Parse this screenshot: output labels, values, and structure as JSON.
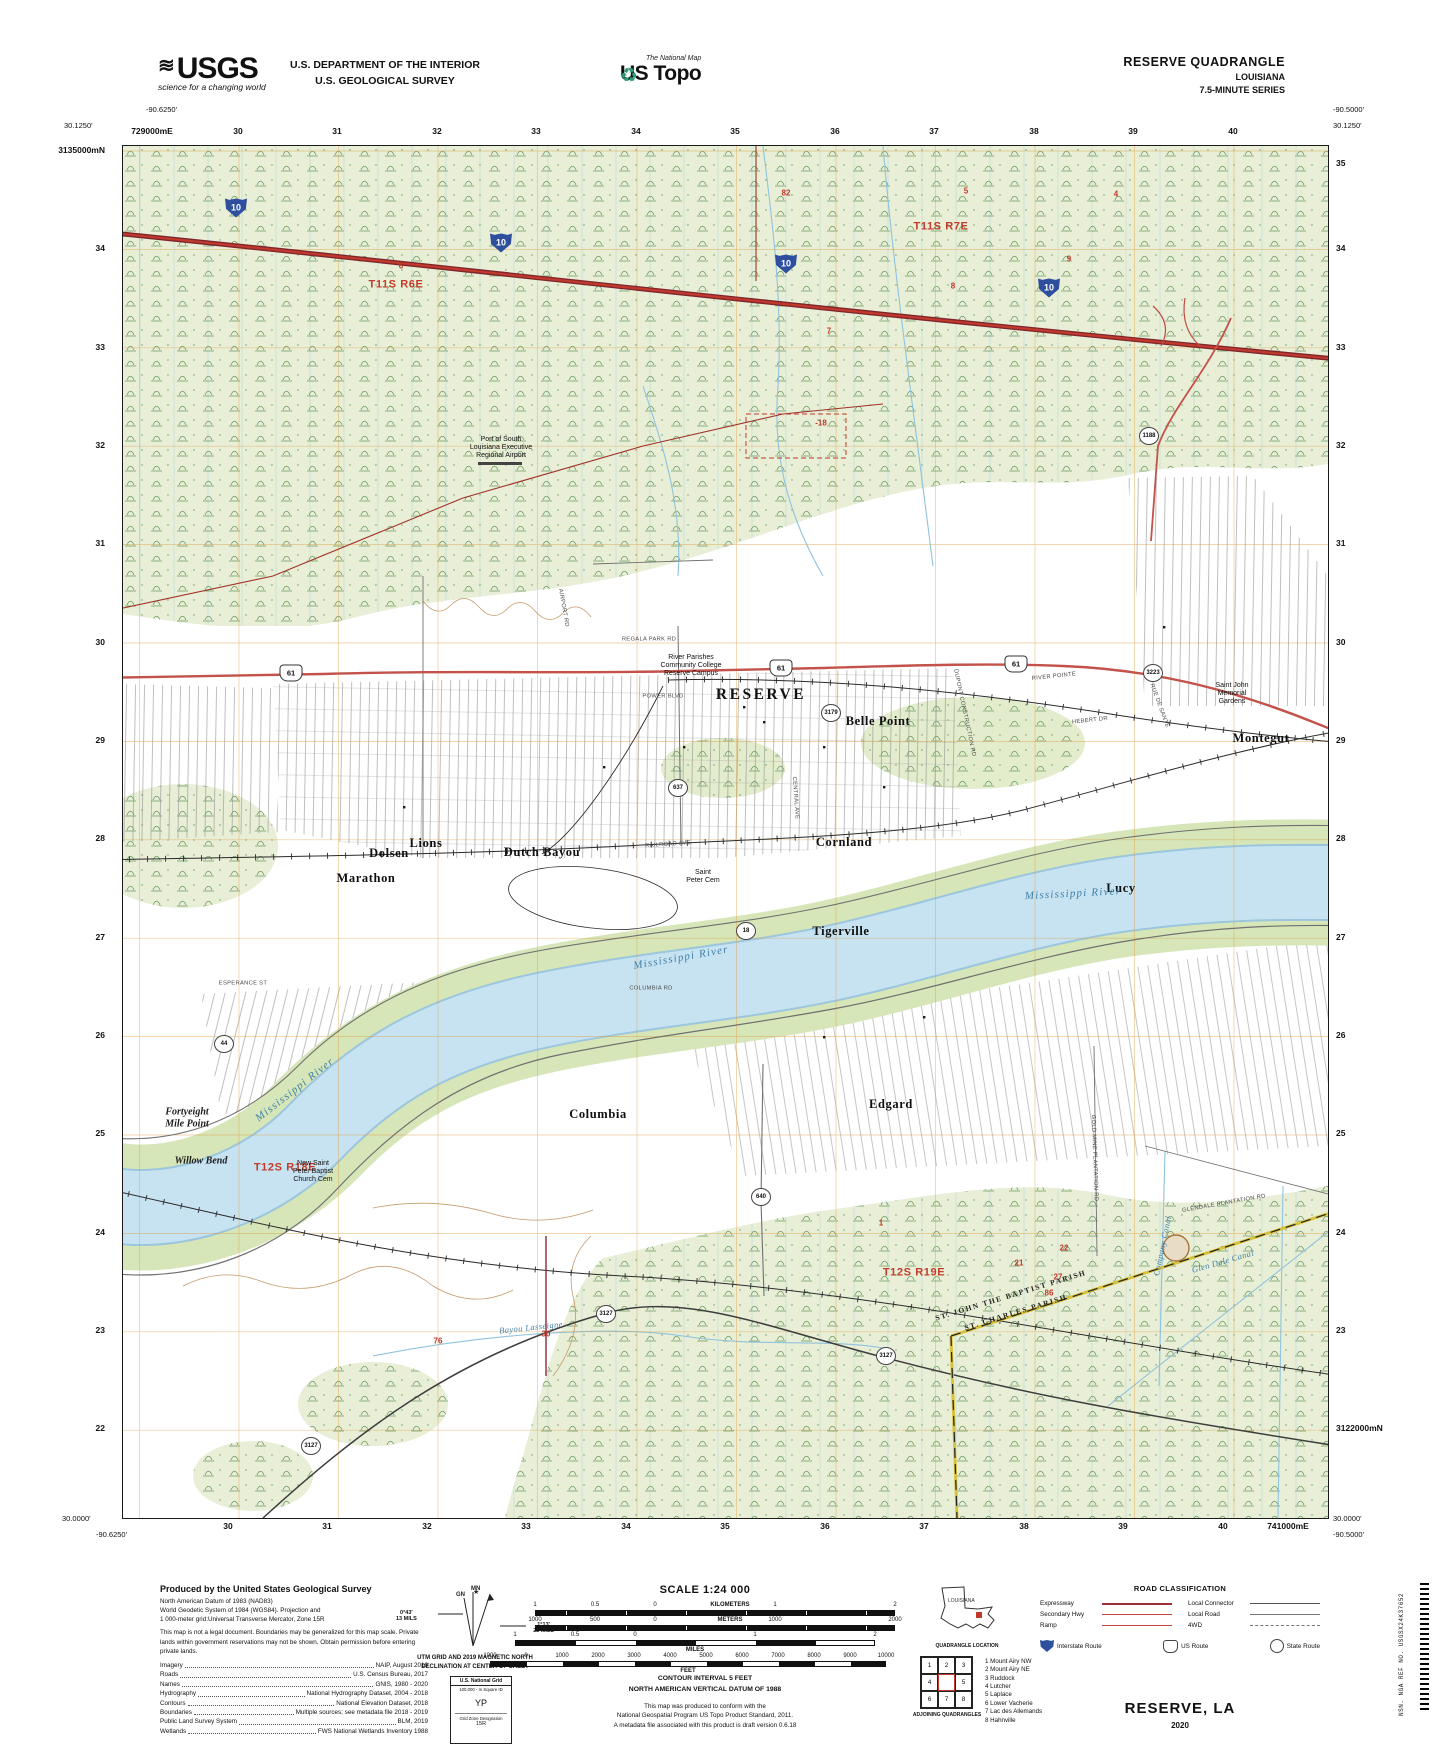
{
  "header": {
    "usgs_word": "USGS",
    "usgs_tagline": "science for a changing world",
    "dept_line1": "U.S. DEPARTMENT OF THE INTERIOR",
    "dept_line2": "U.S. GEOLOGICAL SURVEY",
    "natmap_small": "The National Map",
    "natmap_big": "US Topo",
    "quad_title": "RESERVE QUADRANGLE",
    "quad_state": "LOUISIANA",
    "quad_series": "7.5-MINUTE SERIES"
  },
  "map": {
    "corners": {
      "tl_lon": "-90.6250'",
      "tl_lat": "30.1250'",
      "tr_lon": "-90.5000'",
      "tr_lat": "30.1250'",
      "bl_lat": "30.0000'",
      "bl_lon": "-90.6250'",
      "br_lat": "30.0000'",
      "br_lon": "-90.5000'"
    },
    "utm_top": [
      {
        "t": "729000mE",
        "x": 152
      },
      {
        "t": "30",
        "x": 238
      },
      {
        "t": "31",
        "x": 337
      },
      {
        "t": "32",
        "x": 437
      },
      {
        "t": "33",
        "x": 536
      },
      {
        "t": "34",
        "x": 636
      },
      {
        "t": "35",
        "x": 735
      },
      {
        "t": "36",
        "x": 835
      },
      {
        "t": "37",
        "x": 934
      },
      {
        "t": "38",
        "x": 1034
      },
      {
        "t": "39",
        "x": 1133
      },
      {
        "t": "40",
        "x": 1233
      }
    ],
    "utm_bottom": [
      {
        "t": "30",
        "x": 228
      },
      {
        "t": "31",
        "x": 327
      },
      {
        "t": "32",
        "x": 427
      },
      {
        "t": "33",
        "x": 526
      },
      {
        "t": "34",
        "x": 626
      },
      {
        "t": "35",
        "x": 725
      },
      {
        "t": "36",
        "x": 825
      },
      {
        "t": "37",
        "x": 924
      },
      {
        "t": "38",
        "x": 1024
      },
      {
        "t": "39",
        "x": 1123
      },
      {
        "t": "40",
        "x": 1223
      },
      {
        "t": "741000mE",
        "x": 1288
      }
    ],
    "utm_left": [
      {
        "t": "3135000mN",
        "y": 150
      },
      {
        "t": "34",
        "y": 248
      },
      {
        "t": "33",
        "y": 347
      },
      {
        "t": "32",
        "y": 445
      },
      {
        "t": "31",
        "y": 543
      },
      {
        "t": "30",
        "y": 642
      },
      {
        "t": "29",
        "y": 740
      },
      {
        "t": "28",
        "y": 838
      },
      {
        "t": "27",
        "y": 937
      },
      {
        "t": "26",
        "y": 1035
      },
      {
        "t": "25",
        "y": 1133
      },
      {
        "t": "24",
        "y": 1232
      },
      {
        "t": "23",
        "y": 1330
      },
      {
        "t": "22",
        "y": 1428
      }
    ],
    "utm_right": [
      {
        "t": "35",
        "y": 163
      },
      {
        "t": "34",
        "y": 248
      },
      {
        "t": "33",
        "y": 347
      },
      {
        "t": "32",
        "y": 445
      },
      {
        "t": "31",
        "y": 543
      },
      {
        "t": "30",
        "y": 642
      },
      {
        "t": "29",
        "y": 740
      },
      {
        "t": "28",
        "y": 838
      },
      {
        "t": "27",
        "y": 937
      },
      {
        "t": "26",
        "y": 1035
      },
      {
        "t": "25",
        "y": 1133
      },
      {
        "t": "24",
        "y": 1232
      },
      {
        "t": "23",
        "y": 1330
      },
      {
        "t": "3122000mN",
        "y": 1428
      }
    ],
    "labels": [
      {
        "t": "T11S R6E",
        "x": 273,
        "y": 139,
        "cls": "twp"
      },
      {
        "t": "T11S R7E",
        "x": 818,
        "y": 81,
        "cls": "twp"
      },
      {
        "t": "T12S R18E",
        "x": 162,
        "y": 1022,
        "cls": "twp"
      },
      {
        "t": "T12S R19E",
        "x": 791,
        "y": 1127,
        "cls": "twp"
      },
      {
        "t": "RESERVE",
        "x": 638,
        "y": 549,
        "cls": "town lg"
      },
      {
        "t": "Montegut",
        "x": 1138,
        "y": 592,
        "cls": "town"
      },
      {
        "t": "Belle Point",
        "x": 755,
        "y": 575,
        "cls": "town"
      },
      {
        "t": "Cornland",
        "x": 721,
        "y": 696,
        "cls": "town"
      },
      {
        "t": "Dolsen",
        "x": 266,
        "y": 707,
        "cls": "town"
      },
      {
        "t": "Marathon",
        "x": 243,
        "y": 732,
        "cls": "town"
      },
      {
        "t": "Dutch Bayou",
        "x": 419,
        "y": 706,
        "cls": "town"
      },
      {
        "t": "Lions",
        "x": 303,
        "y": 697,
        "cls": "town"
      },
      {
        "t": "Lucy",
        "x": 998,
        "y": 742,
        "cls": "town"
      },
      {
        "t": "Tigerville",
        "x": 718,
        "y": 785,
        "cls": "town"
      },
      {
        "t": "Edgard",
        "x": 768,
        "y": 958,
        "cls": "town"
      },
      {
        "t": "Columbia",
        "x": 475,
        "y": 968,
        "cls": "town"
      },
      {
        "t": "Fortyeight\nMile Point",
        "x": 64,
        "y": 972,
        "cls": "phys"
      },
      {
        "t": "Willow Bend",
        "x": 78,
        "y": 1015,
        "cls": "phys"
      },
      {
        "t": "Mississippi River",
        "x": 172,
        "y": 944,
        "cls": "water",
        "r": -38
      },
      {
        "t": "Mississippi River",
        "x": 558,
        "y": 812,
        "cls": "water",
        "r": -10
      },
      {
        "t": "Mississippi River",
        "x": 950,
        "y": 748,
        "cls": "water",
        "r": -3
      },
      {
        "t": "Company Canal",
        "x": 1040,
        "y": 1100,
        "cls": "water sm",
        "r": -78
      },
      {
        "t": "Glen Dale Canal",
        "x": 1100,
        "y": 1116,
        "cls": "water sm",
        "r": -16
      },
      {
        "t": "Bayou Lasseigne",
        "x": 408,
        "y": 1182,
        "cls": "water sm",
        "r": -6
      },
      {
        "t": "ST. JOHN THE BAPTIST PARISH",
        "x": 888,
        "y": 1150,
        "cls": "parish",
        "r": -17
      },
      {
        "t": "ST. CHARLES PARISH",
        "x": 893,
        "y": 1167,
        "cls": "parish",
        "r": -17
      },
      {
        "t": "Port of South\nLouisiana Executive\nRegional Airport",
        "x": 378,
        "y": 302,
        "cls": "poi"
      },
      {
        "t": "River Parishes\nCommunity College\nReserve Campus",
        "x": 568,
        "y": 520,
        "cls": "poi"
      },
      {
        "t": "Saint John\nMemorial\nGardens",
        "x": 1109,
        "y": 548,
        "cls": "poi"
      },
      {
        "t": "New Saint\nPeter Baptist\nChurch Cem",
        "x": 190,
        "y": 1026,
        "cls": "poi"
      },
      {
        "t": "Saint\nPeter Cem",
        "x": 580,
        "y": 731,
        "cls": "poi"
      },
      {
        "t": "REGALA PARK RD",
        "x": 526,
        "y": 494,
        "cls": "rd"
      },
      {
        "t": "POWER BLVD",
        "x": 540,
        "y": 551,
        "cls": "rd"
      },
      {
        "t": "RAILROAD AVE",
        "x": 545,
        "y": 699,
        "cls": "rd",
        "r": -4
      },
      {
        "t": "RIVER POINTE",
        "x": 931,
        "y": 531,
        "cls": "rd",
        "r": -6
      },
      {
        "t": "HEBERT DR",
        "x": 967,
        "y": 575,
        "cls": "rd",
        "r": -6
      },
      {
        "t": "RUE DE SANTE",
        "x": 1036,
        "y": 560,
        "cls": "rd",
        "r": 70
      },
      {
        "t": "DUPONT CONSTRUCTION RD",
        "x": 841,
        "y": 567,
        "cls": "rd",
        "r": 78
      },
      {
        "t": "CENTRAL AVE",
        "x": 672,
        "y": 652,
        "cls": "rd",
        "r": 86
      },
      {
        "t": "GOLD MINE PLANTATION RD",
        "x": 971,
        "y": 1012,
        "cls": "rd",
        "r": 88
      },
      {
        "t": "GLENDALE PLANTATION RD",
        "x": 1101,
        "y": 1058,
        "cls": "rd",
        "r": -10
      },
      {
        "t": "COLUMBIA RD",
        "x": 528,
        "y": 843,
        "cls": "rd"
      },
      {
        "t": "AIRPORT RD",
        "x": 440,
        "y": 462,
        "cls": "rd",
        "r": 80
      },
      {
        "t": "ESPERANCE ST",
        "x": 120,
        "y": 838,
        "cls": "rd"
      },
      {
        "t": "82",
        "x": 663,
        "y": 47,
        "cls": "rn"
      },
      {
        "t": "6",
        "x": 278,
        "y": 120,
        "cls": "rn"
      },
      {
        "t": "5",
        "x": 843,
        "y": 45,
        "cls": "rn"
      },
      {
        "t": "4",
        "x": 993,
        "y": 48,
        "cls": "rn"
      },
      {
        "t": "9",
        "x": 946,
        "y": 113,
        "cls": "rn"
      },
      {
        "t": "8",
        "x": 830,
        "y": 140,
        "cls": "rn"
      },
      {
        "t": "7",
        "x": 706,
        "y": 185,
        "cls": "rn"
      },
      {
        "t": "-18",
        "x": 698,
        "y": 277,
        "cls": "rn"
      },
      {
        "t": "1",
        "x": 758,
        "y": 1077,
        "cls": "rn"
      },
      {
        "t": "76",
        "x": 315,
        "y": 1195,
        "cls": "rn"
      },
      {
        "t": "30",
        "x": 423,
        "y": 1188,
        "cls": "rn"
      },
      {
        "t": "22",
        "x": 941,
        "y": 1102,
        "cls": "rn"
      },
      {
        "t": "21",
        "x": 896,
        "y": 1117,
        "cls": "rn"
      },
      {
        "t": "27",
        "x": 935,
        "y": 1131,
        "cls": "rn"
      },
      {
        "t": "86",
        "x": 926,
        "y": 1147,
        "cls": "rn"
      },
      {
        "t": "10",
        "x": 113,
        "y": 62,
        "cls": "sh-i"
      },
      {
        "t": "10",
        "x": 378,
        "y": 97,
        "cls": "sh-i"
      },
      {
        "t": "10",
        "x": 663,
        "y": 118,
        "cls": "sh-i"
      },
      {
        "t": "10",
        "x": 926,
        "y": 142,
        "cls": "sh-i"
      },
      {
        "t": "61",
        "x": 168,
        "y": 527,
        "cls": "sh-u"
      },
      {
        "t": "61",
        "x": 658,
        "y": 522,
        "cls": "sh-u"
      },
      {
        "t": "61",
        "x": 893,
        "y": 518,
        "cls": "sh-u"
      },
      {
        "t": "637",
        "x": 555,
        "y": 642,
        "cls": "sh-s"
      },
      {
        "t": "3179",
        "x": 708,
        "y": 567,
        "cls": "sh-s"
      },
      {
        "t": "3223",
        "x": 1030,
        "y": 527,
        "cls": "sh-s"
      },
      {
        "t": "1188",
        "x": 1026,
        "y": 290,
        "cls": "sh-s"
      },
      {
        "t": "44",
        "x": 101,
        "y": 898,
        "cls": "sh-s"
      },
      {
        "t": "18",
        "x": 623,
        "y": 785,
        "cls": "sh-s"
      },
      {
        "t": "640",
        "x": 638,
        "y": 1051,
        "cls": "sh-s"
      },
      {
        "t": "3127",
        "x": 483,
        "y": 1168,
        "cls": "sh-s"
      },
      {
        "t": "3127",
        "x": 763,
        "y": 1210,
        "cls": "sh-s"
      },
      {
        "t": "3127",
        "x": 188,
        "y": 1300,
        "cls": "sh-s"
      }
    ]
  },
  "footer": {
    "produced": {
      "title": "Produced by the United States Geological Survey",
      "lines": [
        "North American Datum of 1983 (NAD83)",
        "World Geodetic System of 1984 (WGS84).  Projection and",
        "1 000-meter grid:Universal Transverse Mercator, Zone 15R"
      ],
      "legal": "This map is not a legal document. Boundaries may be generalized for this map scale. Private lands within government reservations may not be shown. Obtain permission before entering private lands.",
      "sources": [
        {
          "k": "Imagery",
          "v": "NAIP, August 2019"
        },
        {
          "k": "Roads",
          "v": "U.S. Census Bureau, 2017"
        },
        {
          "k": "Names",
          "v": "GNIS, 1980 - 2020"
        },
        {
          "k": "Hydrography",
          "v": "National Hydrography Dataset, 2004 - 2018"
        },
        {
          "k": "Contours",
          "v": "National Elevation Dataset, 2018"
        },
        {
          "k": "Boundaries",
          "v": "Multiple sources; see metadata file 2018 - 2019"
        },
        {
          "k": "Public Land Survey System",
          "v": "BLM, 2019"
        },
        {
          "k": "Wetlands",
          "v": "FWS National Wetlands Inventory 1988"
        }
      ]
    },
    "declination": {
      "mn": "MN",
      "gn": "GN",
      "gn_deg": "0°43'",
      "gn_mils": "13 MILS",
      "mn_deg": "1°13'",
      "mn_mils": "22 MILS",
      "caption1": "UTM GRID AND 2019 MAGNETIC NORTH",
      "caption2": "DECLINATION AT CENTER OF SHEET"
    },
    "usng": {
      "title": "U.S. National Grid",
      "sub": "100,000 - m Square ID",
      "square": "YP",
      "zone_label": "Grid Zone Designation",
      "zone": "15R"
    },
    "scale": {
      "title": "SCALE 1:24 000",
      "km_ticks": [
        {
          "t": "1",
          "x": 0
        },
        {
          "t": "0.5",
          "x": 60
        },
        {
          "t": "0",
          "x": 120
        },
        {
          "t": "KILOMETERS",
          "x": 195,
          "cls": "unit"
        },
        {
          "t": "1",
          "x": 240
        },
        {
          "t": "2",
          "x": 360
        }
      ],
      "m_ticks": [
        {
          "t": "1000",
          "x": 0
        },
        {
          "t": "500",
          "x": 60
        },
        {
          "t": "0",
          "x": 120
        },
        {
          "t": "METERS",
          "x": 195,
          "cls": "unit"
        },
        {
          "t": "1000",
          "x": 240
        },
        {
          "t": "2000",
          "x": 360
        }
      ],
      "mi_ticks": [
        {
          "t": "1",
          "x": 0
        },
        {
          "t": "0.5",
          "x": 60
        },
        {
          "t": "0",
          "x": 120
        },
        {
          "t": "1",
          "x": 240
        },
        {
          "t": "2",
          "x": 360
        }
      ],
      "mi_word": "MILES",
      "ft_ticks": [
        {
          "t": "1000",
          "x": 0
        },
        {
          "t": "0",
          "x": 36
        },
        {
          "t": "1000",
          "x": 72
        },
        {
          "t": "2000",
          "x": 108
        },
        {
          "t": "3000",
          "x": 144
        },
        {
          "t": "4000",
          "x": 180
        },
        {
          "t": "5000",
          "x": 216
        },
        {
          "t": "6000",
          "x": 252
        },
        {
          "t": "7000",
          "x": 288
        },
        {
          "t": "8000",
          "x": 324
        },
        {
          "t": "9000",
          "x": 360
        },
        {
          "t": "10000",
          "x": 396
        }
      ],
      "ft_word": "FEET",
      "contour": "CONTOUR INTERVAL 5 FEET",
      "vdatum": "NORTH AMERICAN VERTICAL DATUM OF 1988",
      "std1": "This map was produced to conform with the",
      "std2": "National Geospatial Program US Topo Product Standard, 2011.",
      "std3": "A metadata file associated with this product is draft version 0.6.18"
    },
    "location": {
      "state": "LOUISIANA",
      "caption": "QUADRANGLE LOCATION"
    },
    "adjoining": {
      "cells": [
        "1",
        "2",
        "3",
        "4",
        "5",
        "6",
        "7",
        "8"
      ],
      "list": [
        "1 Mount Airy NW",
        "2 Mount Airy NE",
        "3 Ruddock",
        "4 Lutcher",
        "5 Laplace",
        "6 Lower Vacherie",
        "7 Lac des Allemands",
        "8 Hahnville"
      ],
      "caption": "ADJOINING QUADRANGLES"
    },
    "roadclass": {
      "title": "ROAD CLASSIFICATION",
      "left_rows": [
        {
          "label": "Expressway",
          "style": ""
        },
        {
          "label": "Secondary Hwy",
          "style": "sec"
        },
        {
          "label": "Ramp",
          "style": "ramp"
        }
      ],
      "right_rows": [
        {
          "label": "Local Connector",
          "style": "lc"
        },
        {
          "label": "Local Road",
          "style": "lr"
        },
        {
          "label": "4WD",
          "style": "fwd"
        }
      ],
      "sh_interstate": "Interstate Route",
      "sh_us": "US Route",
      "sh_state": "State Route"
    },
    "title_block": {
      "name": "RESERVE, LA",
      "year": "2020"
    },
    "sidebar": "NSN.  NGA REF NO. USGSX24K37652"
  }
}
